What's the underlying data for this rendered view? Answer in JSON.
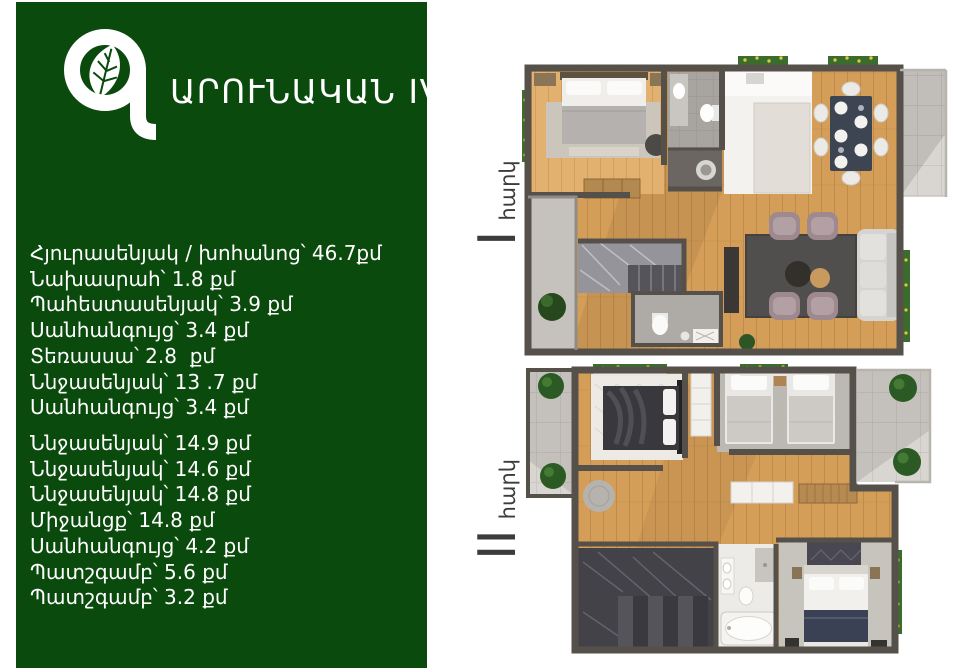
{
  "brand": {
    "logo_letter": "Գ",
    "name_rest": "ԱՐՈՒՆԱԿԱՆ",
    "number": "IV"
  },
  "colors": {
    "panel_green": "#0b4a0d",
    "label_text": "#3c3c3c",
    "wall_gray": "#56504b",
    "wood": "#d49e58"
  },
  "floor1": {
    "label_numeral": "I",
    "label_word": "հարկ",
    "rooms": [
      "Հյուրասենյակ / խոհանոց՝ 46.7քմ",
      "Նախասրահ՝ 1.8 քմ",
      "Պահեստասենյակ՝ 3.9 քմ",
      "Սանհանգույց՝ 3.4 քմ",
      "Տեռասսա՝ 2.8  քմ",
      "Ննջասենյակ՝ 13 .7 քմ",
      "Սանհանգույց՝ 3.4 քմ"
    ]
  },
  "floor2": {
    "label_numeral": "II",
    "label_word": "հարկ",
    "rooms": [
      "Ննջասենյակ՝ 14.9 քմ",
      "Ննջասենյակ՝ 14.6 քմ",
      "Ննջասենյակ՝ 14.8 քմ",
      "Միջանցք՝ 14.8 քմ",
      "Սանհանգույց՝ 4.2 քմ",
      "Պատշգամբ՝ 5.6 քմ",
      "Պատշգամբ՝ 3.2 քմ"
    ]
  }
}
